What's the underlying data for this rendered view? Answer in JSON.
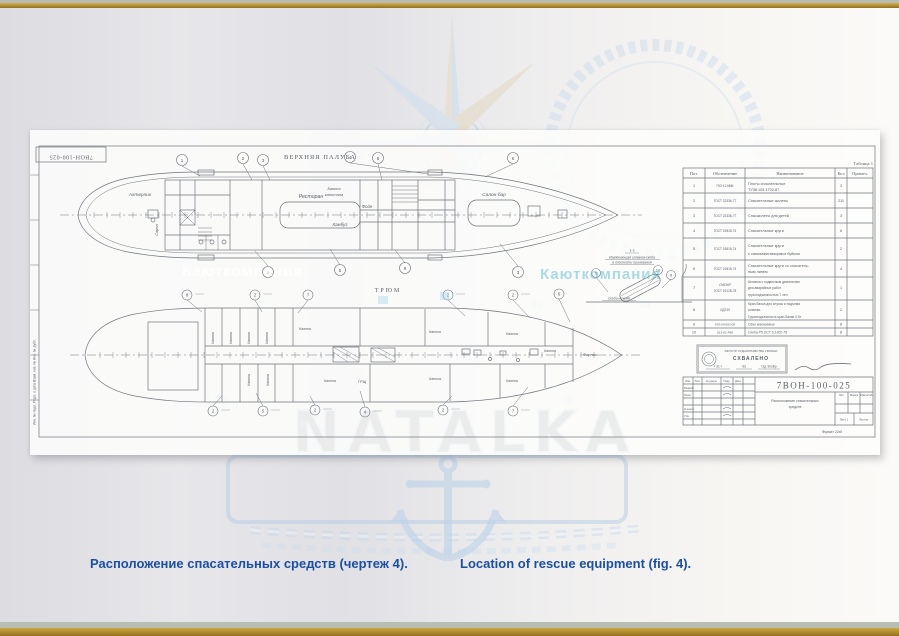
{
  "captions": {
    "ru": "Расположение спасательных средств (чертеж 4).",
    "en": "Location of rescue equipment (fig. 4)."
  },
  "watermark": {
    "brand": "NATALKA",
    "overlay_text": "Каюткомпания"
  },
  "sheet": {
    "corner_number": "7ВОН-100-025",
    "frame_left_text": "Инв. № подл.     Подп. и дата     Взам. инв. №     Инв. № дубл.",
    "upper_deck": {
      "title": "ВЕРХНЯЯ ПАЛУБА",
      "rooms": {
        "aft_peak": "Ахтерпик",
        "sauna": "Сауна",
        "restaurant": "Ресторан",
        "captain1": "Каюта",
        "captain2": "капитана",
        "foyer": "Фойе",
        "galley": "Камбуз",
        "salon": "Салон-бар"
      },
      "callouts_top": [
        "1",
        "2",
        "3",
        "4",
        "8",
        "6"
      ],
      "callouts_bottom": [
        "7",
        "5",
        "9",
        "3"
      ]
    },
    "lower_deck": {
      "title": "ТРЮМ",
      "cabin": "Каюта",
      "forepeak": "Форпик",
      "switchboard": "ГРЩ",
      "callouts_top": [
        "8",
        "2",
        "7",
        "2",
        "2",
        "6"
      ],
      "callouts_bottom": [
        "2",
        "5",
        "2",
        "4",
        "2",
        "7"
      ]
    },
    "detail": {
      "title": "1-1",
      "note1": "Извлекающая штанга-скоба",
      "note2": "в плоскости прилегания",
      "note3": "Скоба нижняя",
      "callouts": [
        "9",
        "10",
        "8"
      ]
    },
    "table": {
      "caption": "Таблица 1",
      "headers": [
        "Поз.",
        "Обозначение",
        "Наименование",
        "Кол",
        "Примеч."
      ],
      "rows": [
        {
          "pos": "1",
          "code": "ПСН-10МК",
          "name": "Плоты спасательные",
          "name2": "ТУ38.105.1702-87",
          "qty": "3"
        },
        {
          "pos": "2",
          "code": "ГОСТ 22336-77",
          "name": "Спасательные жилеты",
          "qty": "211"
        },
        {
          "pos": "3",
          "code": "ГОСТ 22336-77",
          "name": "Спасжилеты для детей",
          "qty": "3"
        },
        {
          "pos": "4",
          "code": "ГОСТ 19815-74",
          "name": "Спасательные круги",
          "qty": "6"
        },
        {
          "pos": "5",
          "code": "ГОСТ 19815-74",
          "name": "Спасательные круги",
          "name2": "с самозажигающимся буйком",
          "qty": "2"
        },
        {
          "pos": "6",
          "code": "ГОСТ 19815-74",
          "name": "Спасательные круги со спасатель-",
          "name2": "ным линем",
          "qty": "4"
        },
        {
          "pos": "7",
          "code": "СМ196Р",
          "code2": "ГОСТ 19128-78",
          "name": "Шлюпка с подвесным двигателем",
          "name2": "для аварийных работ",
          "name3": "грузоподъемностью 7 чел",
          "qty": "1"
        },
        {
          "pos": "8",
          "code": "ЛД315",
          "name": "Кран-балка для спуска и подъема",
          "name2": "шлюпки.",
          "name3": "Грузоподъемность кран-балки 0,5т",
          "qty": "2"
        },
        {
          "pos": "9",
          "code": "970-04.093-05",
          "name": "Огни магниевые",
          "qty": "8"
        },
        {
          "pos": "10",
          "code": "013-01-Р88",
          "name": "Скоба Р5 ОСТ 6.1302-79",
          "qty": "8"
        }
      ]
    },
    "stamp": {
      "org": "РЕГІСТР СУДНОПЛАВСТВА УКРАЇНИ",
      "approved": "СХВАЛЕНО",
      "date_parts": [
        "« 31 »",
        "93",
        "Од. 9поБр"
      ]
    },
    "title_block": {
      "number": "7ВОН-100-025",
      "name1": "Расположение спасательных",
      "name2": "средств",
      "col_labels": [
        "Изм.",
        "Лист",
        "№ докум.",
        "Подп.",
        "Дата"
      ],
      "row_labels": [
        "Разраб.",
        "Пров.",
        "Н.контр.",
        "Утв."
      ],
      "lit": "Лит.",
      "mass": "Масса",
      "scale": "Масштаб",
      "sheet_no": "Лист 1",
      "sheets": "Листов",
      "format_note": "Формат 22х5"
    }
  }
}
